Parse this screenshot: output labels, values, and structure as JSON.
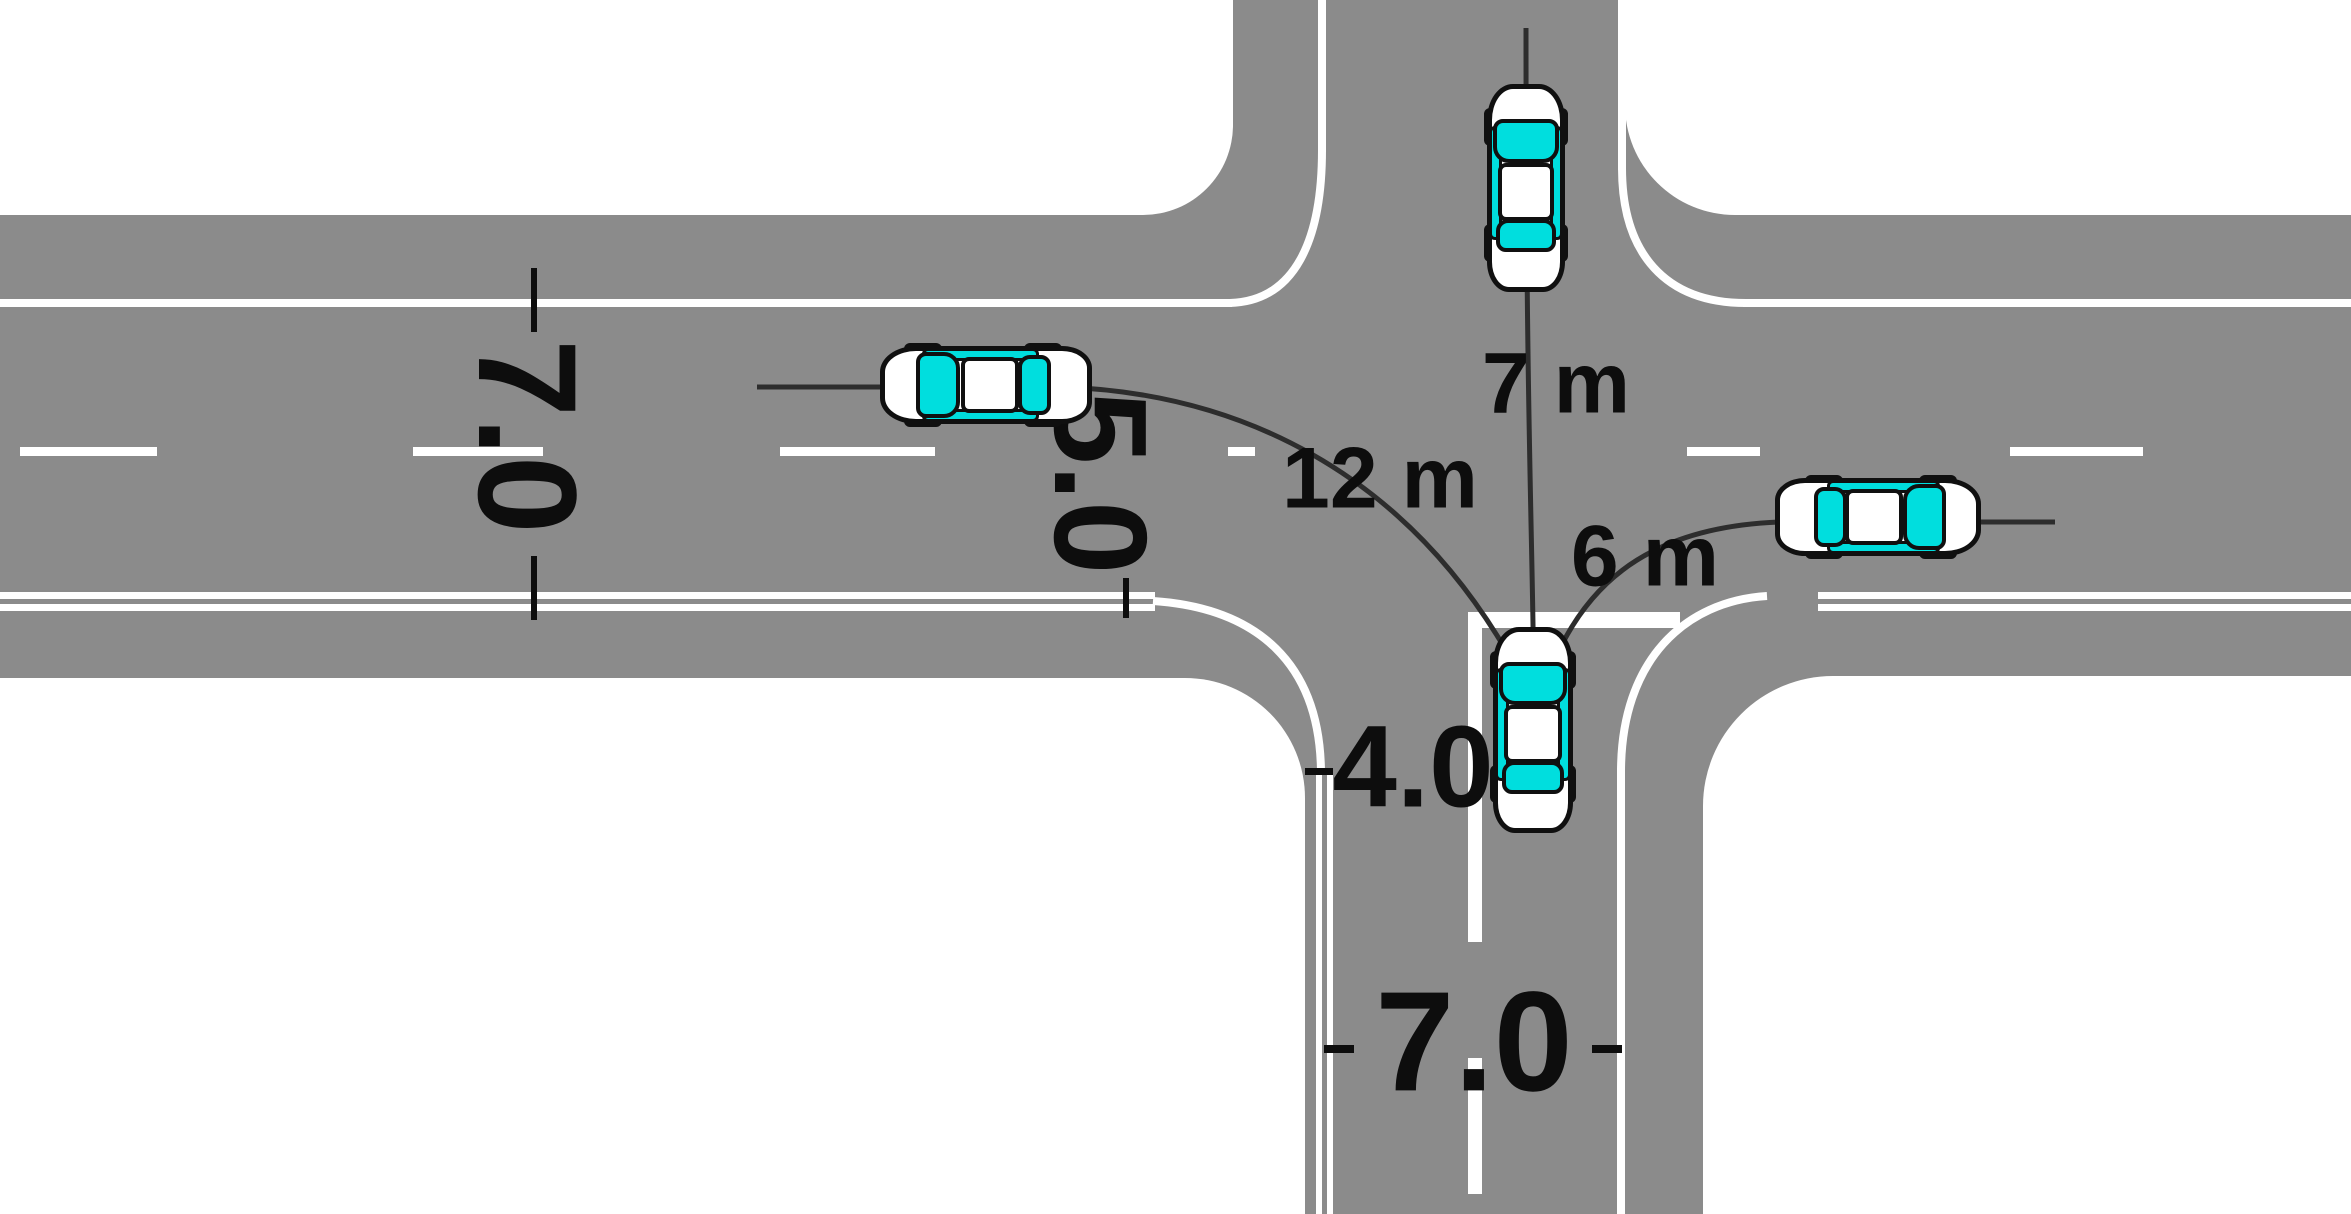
{
  "title": "Intersection geometry and turning-path distances diagram",
  "colors": {
    "road": "#8b8b8b",
    "marking": "#ffffff",
    "trajectory": "#2d2d2d",
    "car_body": "#ffffff",
    "car_glass": "#00dede",
    "outline": "#101010",
    "background": "#ffffff"
  },
  "labels": {
    "west_road_width": "7.0",
    "center_offset": "5.0",
    "exit_lane_width": "4.0",
    "south_road_width": "7.0",
    "straight_distance": "7 m",
    "left_turn_distance": "12 m",
    "right_turn_distance": "6 m"
  },
  "measurements": [
    {
      "name": "west road carriageway width",
      "value": "7.0"
    },
    {
      "name": "offset between center lines",
      "value": "5.0"
    },
    {
      "name": "south approach exit lane width",
      "value": "4.0"
    },
    {
      "name": "south road carriageway width",
      "value": "7.0"
    },
    {
      "name": "straight-through travel distance",
      "value": "7 m"
    },
    {
      "name": "left-turn travel distance",
      "value": "12 m"
    },
    {
      "name": "right-turn travel distance",
      "value": "6 m"
    }
  ],
  "cars": [
    {
      "id": "car-south-approach",
      "description": "car stopped at stop line on south approach, heading north"
    },
    {
      "id": "car-straight-result",
      "description": "car after driving straight 7 m, heading north"
    },
    {
      "id": "car-left-turn-result",
      "description": "car after turning left along 12 m path, heading west"
    },
    {
      "id": "car-right-turn-result",
      "description": "car after turning right along 6 m path, heading east"
    }
  ]
}
